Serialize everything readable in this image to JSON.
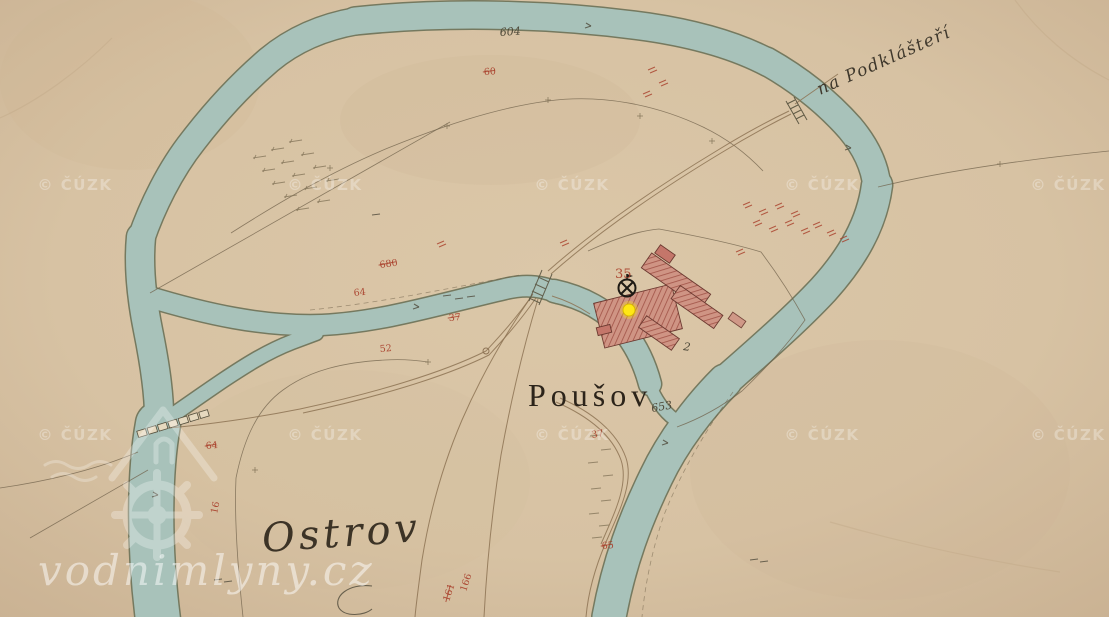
{
  "map": {
    "place_labels": [
      {
        "id": "pousov",
        "text": "Poušov"
      },
      {
        "id": "ostrov",
        "text": "Ostrov"
      },
      {
        "id": "na_podklasteri",
        "text": "na Podklášteří"
      }
    ],
    "ink_numbers": [
      {
        "text": "604",
        "x": 500,
        "y": 36,
        "rot": -4
      },
      {
        "text": "653",
        "x": 652,
        "y": 412,
        "rot": -10
      },
      {
        "text": "2",
        "x": 683,
        "y": 350,
        "rot": 8
      }
    ],
    "red_numbers": [
      {
        "text": "35",
        "x": 615,
        "y": 278,
        "rot": 0,
        "size": 13
      },
      {
        "text": "60",
        "x": 484,
        "y": 75,
        "rot": -3,
        "strike": true
      },
      {
        "text": "680",
        "x": 380,
        "y": 268,
        "rot": -8,
        "strike": true
      },
      {
        "text": "64",
        "x": 354,
        "y": 296,
        "rot": -6
      },
      {
        "text": "37",
        "x": 449,
        "y": 321,
        "rot": -5,
        "strike": true
      },
      {
        "text": "52",
        "x": 380,
        "y": 352,
        "rot": -5
      },
      {
        "text": "64",
        "x": 206,
        "y": 449,
        "rot": -5,
        "strike": true
      },
      {
        "text": "16",
        "x": 217,
        "y": 514,
        "rot": -78
      },
      {
        "text": "37",
        "x": 592,
        "y": 438,
        "rot": -10
      },
      {
        "text": "65",
        "x": 602,
        "y": 549,
        "rot": -5,
        "strike": true
      },
      {
        "text": "161",
        "x": 449,
        "y": 602,
        "rot": -72,
        "strike": true
      },
      {
        "text": "166",
        "x": 466,
        "y": 592,
        "rot": -72
      }
    ],
    "watermarks": {
      "cuzk": {
        "text": "© ČÚZK",
        "positions": [
          [
            75,
            190
          ],
          [
            325,
            190
          ],
          [
            572,
            190
          ],
          [
            822,
            190
          ],
          [
            1068,
            190
          ],
          [
            75,
            440
          ],
          [
            325,
            440
          ],
          [
            572,
            440
          ],
          [
            822,
            440
          ],
          [
            1068,
            440
          ]
        ]
      },
      "vodnimlyny": {
        "text": "vodnimlyny.cz"
      }
    },
    "marker": {
      "x": 629,
      "y": 310,
      "color": "#ffe715"
    },
    "colors": {
      "parchment": "#d7c2a3",
      "river": "#a8c2ba",
      "building_red": "#cf9484",
      "annotation_red": "#a83c28",
      "ink": "#4e4939"
    }
  }
}
